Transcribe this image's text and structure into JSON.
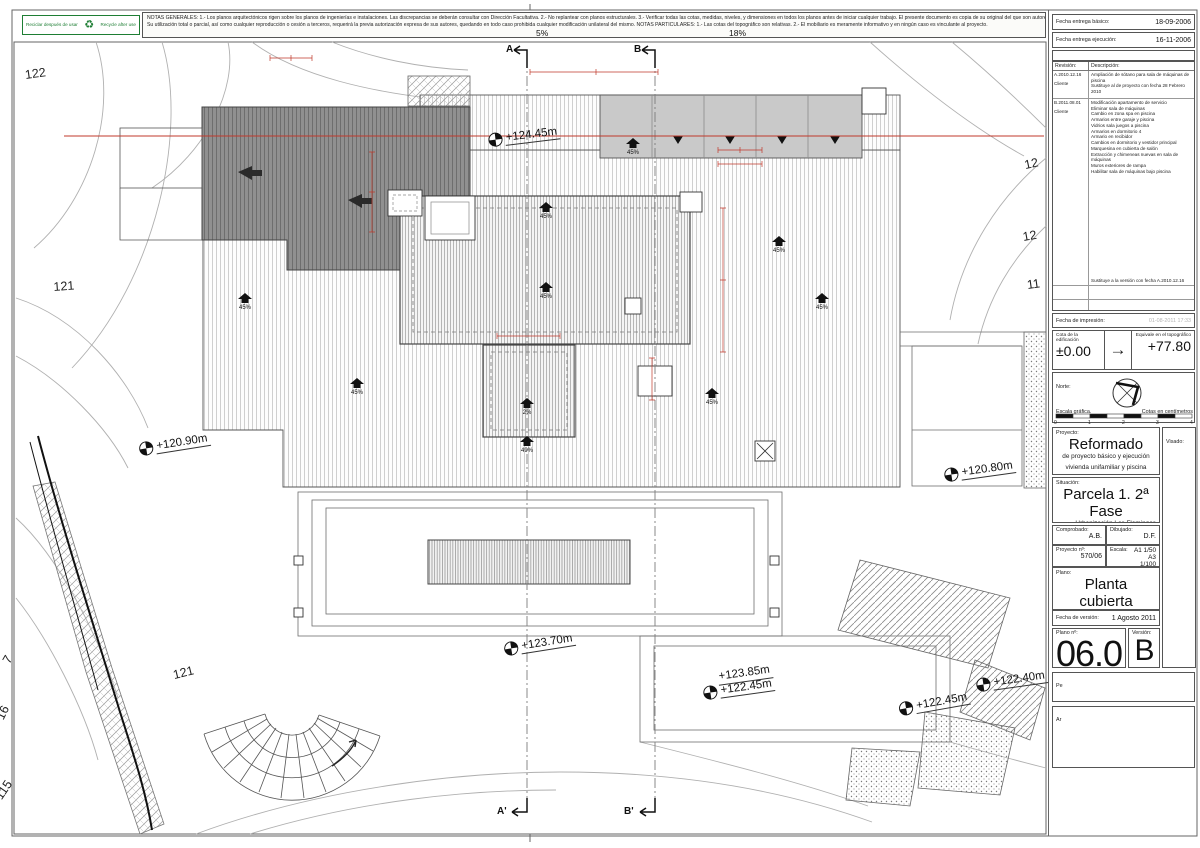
{
  "recycle": {
    "left_label": "Reciclar después de usar",
    "right_label": "Recycle after use"
  },
  "notes": {
    "line1": "NOTAS GENERALES:   1.- Los planos arquitectónicos rigen sobre los planos de ingenierías e instalaciones. Las discrepancias se deberán consultar con Dirección Facultativa.   2.- No replantear con planos estructurales.   3.- Verificar todas las cotas, medidas, niveles, y dimensiones en todos los planos antes de iniciar cualquier trabajo. El presente documento es copia de su original del que son autores los arquitectos",
    "line2": "Su utilización total o parcial, así como cualquier reproducción o cesión a terceros, requerirá la previa autorización expresa de sus autores, quedando en todo caso prohibida cualquier modificación unilateral del mismo.    NOTAS PARTICULARES:   1.- Las cotas del topográfico son relativas.  2.- El mobiliario es meramente informativo y en ningún caso es vinculante al proyecto."
  },
  "titleblock": {
    "fecha_basico_label": "Fecha entrega básico:",
    "fecha_basico_value": "18-09-2006",
    "fecha_ejecucion_label": "Fecha entrega ejecución:",
    "fecha_ejecucion_value": "16-11-2006",
    "modificaciones_label": "Modificaciones:",
    "rev_col": "Revisión:",
    "desc_col": "Descripción:",
    "rev_a_id": "A.2010.12.16",
    "rev_a_by": "Cliente",
    "rev_a_desc": "Ampliación de sótano para sala de máquinas de piscina",
    "rev_a_note": "Sustituye al de proyecto con fecha 28 Febrero 2010",
    "rev_b_id": "B.2011.08.01",
    "rev_b_by": "Cliente",
    "rev_b_desc": "Modificación apartamento de servicio\nEliminar sala de máquinas\nCambio en zona spa en piscina\nArmarios entre garaje y piscina\nVidrios sala juegos a piscina\nArmarios en dormitorio 4\nArmario en recibidor\nCambios en dormitorio y vestidor principal\nMarquesina en cubierta de salón\nExtracción y chimeneas nuevas en sala de máquinas\nMuros exteriores de rampa\nHabilitar sala de máquinas bajo piscina",
    "rev_b_note": "Sustituye a la versión con fecha A.2010.12.16",
    "impresion_label": "Fecha de impresión:",
    "impresion_value": "01-08-2011 17:33",
    "cota_label": "Cota de la edificación",
    "cota_value": "±0.00",
    "arrow": "→",
    "equiv_label": "Equivale en el topográfico",
    "equiv_value": "+77.80",
    "norte_label": "Norte:",
    "escala_grafica": "Escala gráfica.",
    "cotas_cm": "Cotas en centímetros",
    "scale_ticks": [
      "0",
      "1",
      "2",
      "3",
      "4"
    ],
    "proyecto_label": "Proyecto:",
    "proyecto_title": "Reformado",
    "proyecto_sub1": "de proyecto básico y ejecución",
    "proyecto_sub2": "vivienda unifamiliar y piscina",
    "visado_label": "Visado:",
    "situacion_label": "Situación:",
    "situacion_title": "Parcela 1. 2ª Fase",
    "situacion_l1": "Urbanización Los Flamingos",
    "situacion_l2": "Término Municipal de Benahavís",
    "situacion_l3": "Málaga",
    "comprobado_label": "Comprobado:",
    "comprobado_value": "A.B.",
    "dibujado_label": "Dibujado:",
    "dibujado_value": "D.F.",
    "proyecto_n_label": "Proyecto nº:",
    "proyecto_n_value": "570/06",
    "escala_label": "Escala:",
    "escala_v1": "A1 1/50",
    "escala_v2": "A3 1/100",
    "plano_label": "Plano:",
    "plano_title": "Planta cubierta",
    "plano_sub": "Distribución, cotas y pendientes.",
    "fecha_version_label": "Fecha de versión:",
    "fecha_version_value": "1 Agosto 2011",
    "plano_n_label": "Plano nº:",
    "plano_n_value": "06.0",
    "version_label": "Versión:",
    "version_value": "B",
    "pe_label": "Pe",
    "ar_label": "Ar"
  },
  "plan": {
    "sections": [
      {
        "label": "A"
      },
      {
        "label": "B"
      },
      {
        "label": "A'"
      },
      {
        "label": "B'"
      }
    ],
    "top_slopes": [
      {
        "label": "5%"
      },
      {
        "label": "18%"
      }
    ],
    "levels": [
      {
        "text": "+124.45m"
      },
      {
        "text": "+120.90m"
      },
      {
        "text": "+120.80m"
      },
      {
        "text": "+123.70m"
      },
      {
        "line1": "+123.85m",
        "line2": "+122.45m"
      },
      {
        "text": "+122.45m"
      },
      {
        "text": "+122.40m"
      }
    ],
    "slopes": [
      {
        "label": "45%"
      },
      {
        "label": "45%"
      },
      {
        "label": "45%"
      },
      {
        "label": "2%"
      },
      {
        "label": "49%"
      },
      {
        "label": "45%"
      },
      {
        "label": "45%"
      },
      {
        "label": "45%"
      },
      {
        "label": "45%"
      },
      {
        "label": "45%"
      }
    ],
    "contour_labels": [
      {
        "text": "122"
      },
      {
        "text": "121"
      },
      {
        "text": "121"
      },
      {
        "text": "7"
      },
      {
        "text": "16"
      },
      {
        "text": "115"
      },
      {
        "text": "12"
      },
      {
        "text": "12"
      },
      {
        "text": "11"
      }
    ]
  }
}
